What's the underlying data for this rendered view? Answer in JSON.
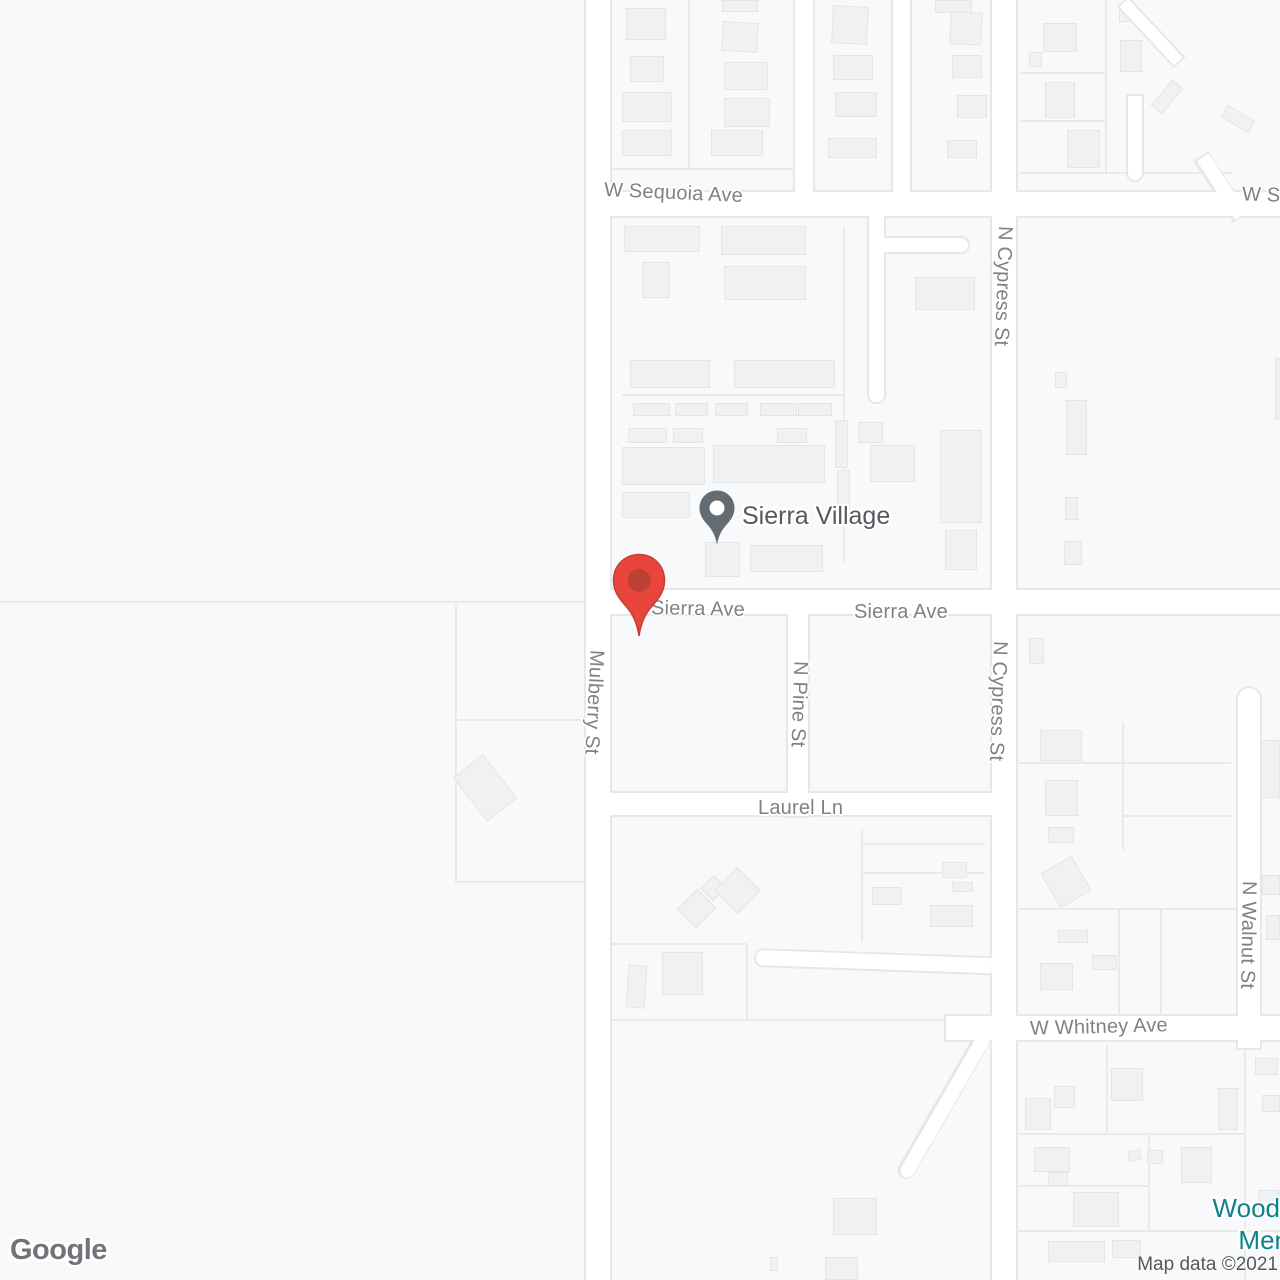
{
  "map": {
    "kind": "google-map-embed",
    "poi": {
      "name": "Sierra Village"
    },
    "poi_secondary": {
      "line1": "Wood",
      "line2": "Men"
    },
    "street_labels": [
      {
        "text": "W Sequoia Ave"
      },
      {
        "text": "W S"
      },
      {
        "text": "N Cypress St"
      },
      {
        "text": "Sierra Ave"
      },
      {
        "text": "Sierra Ave"
      },
      {
        "text": "N Cypress St"
      },
      {
        "text": "Mulberry St"
      },
      {
        "text": "N Pine St"
      },
      {
        "text": "Laurel Ln"
      },
      {
        "text": "W Whitney Ave"
      },
      {
        "text": "N Walnut St"
      }
    ],
    "markers": {
      "dropped_pin_color": "#E8453C",
      "dropped_pin_inner": "#BC4036",
      "poi_pin_color": "#646C73"
    },
    "colors": {
      "background": "#F8F9FA",
      "road_fill": "#FFFFFF",
      "road_casing": "#E5E7EA",
      "building_fill": "#F0F1F2",
      "building_stroke": "#E3E5E8",
      "parcel_line": "#E9EAEC",
      "street_label": "#7D8287",
      "poi_label": "#54595E",
      "poi_teal": "#0C828C"
    },
    "footer": {
      "logo": "Google",
      "attribution": "Map data ©2021"
    }
  }
}
